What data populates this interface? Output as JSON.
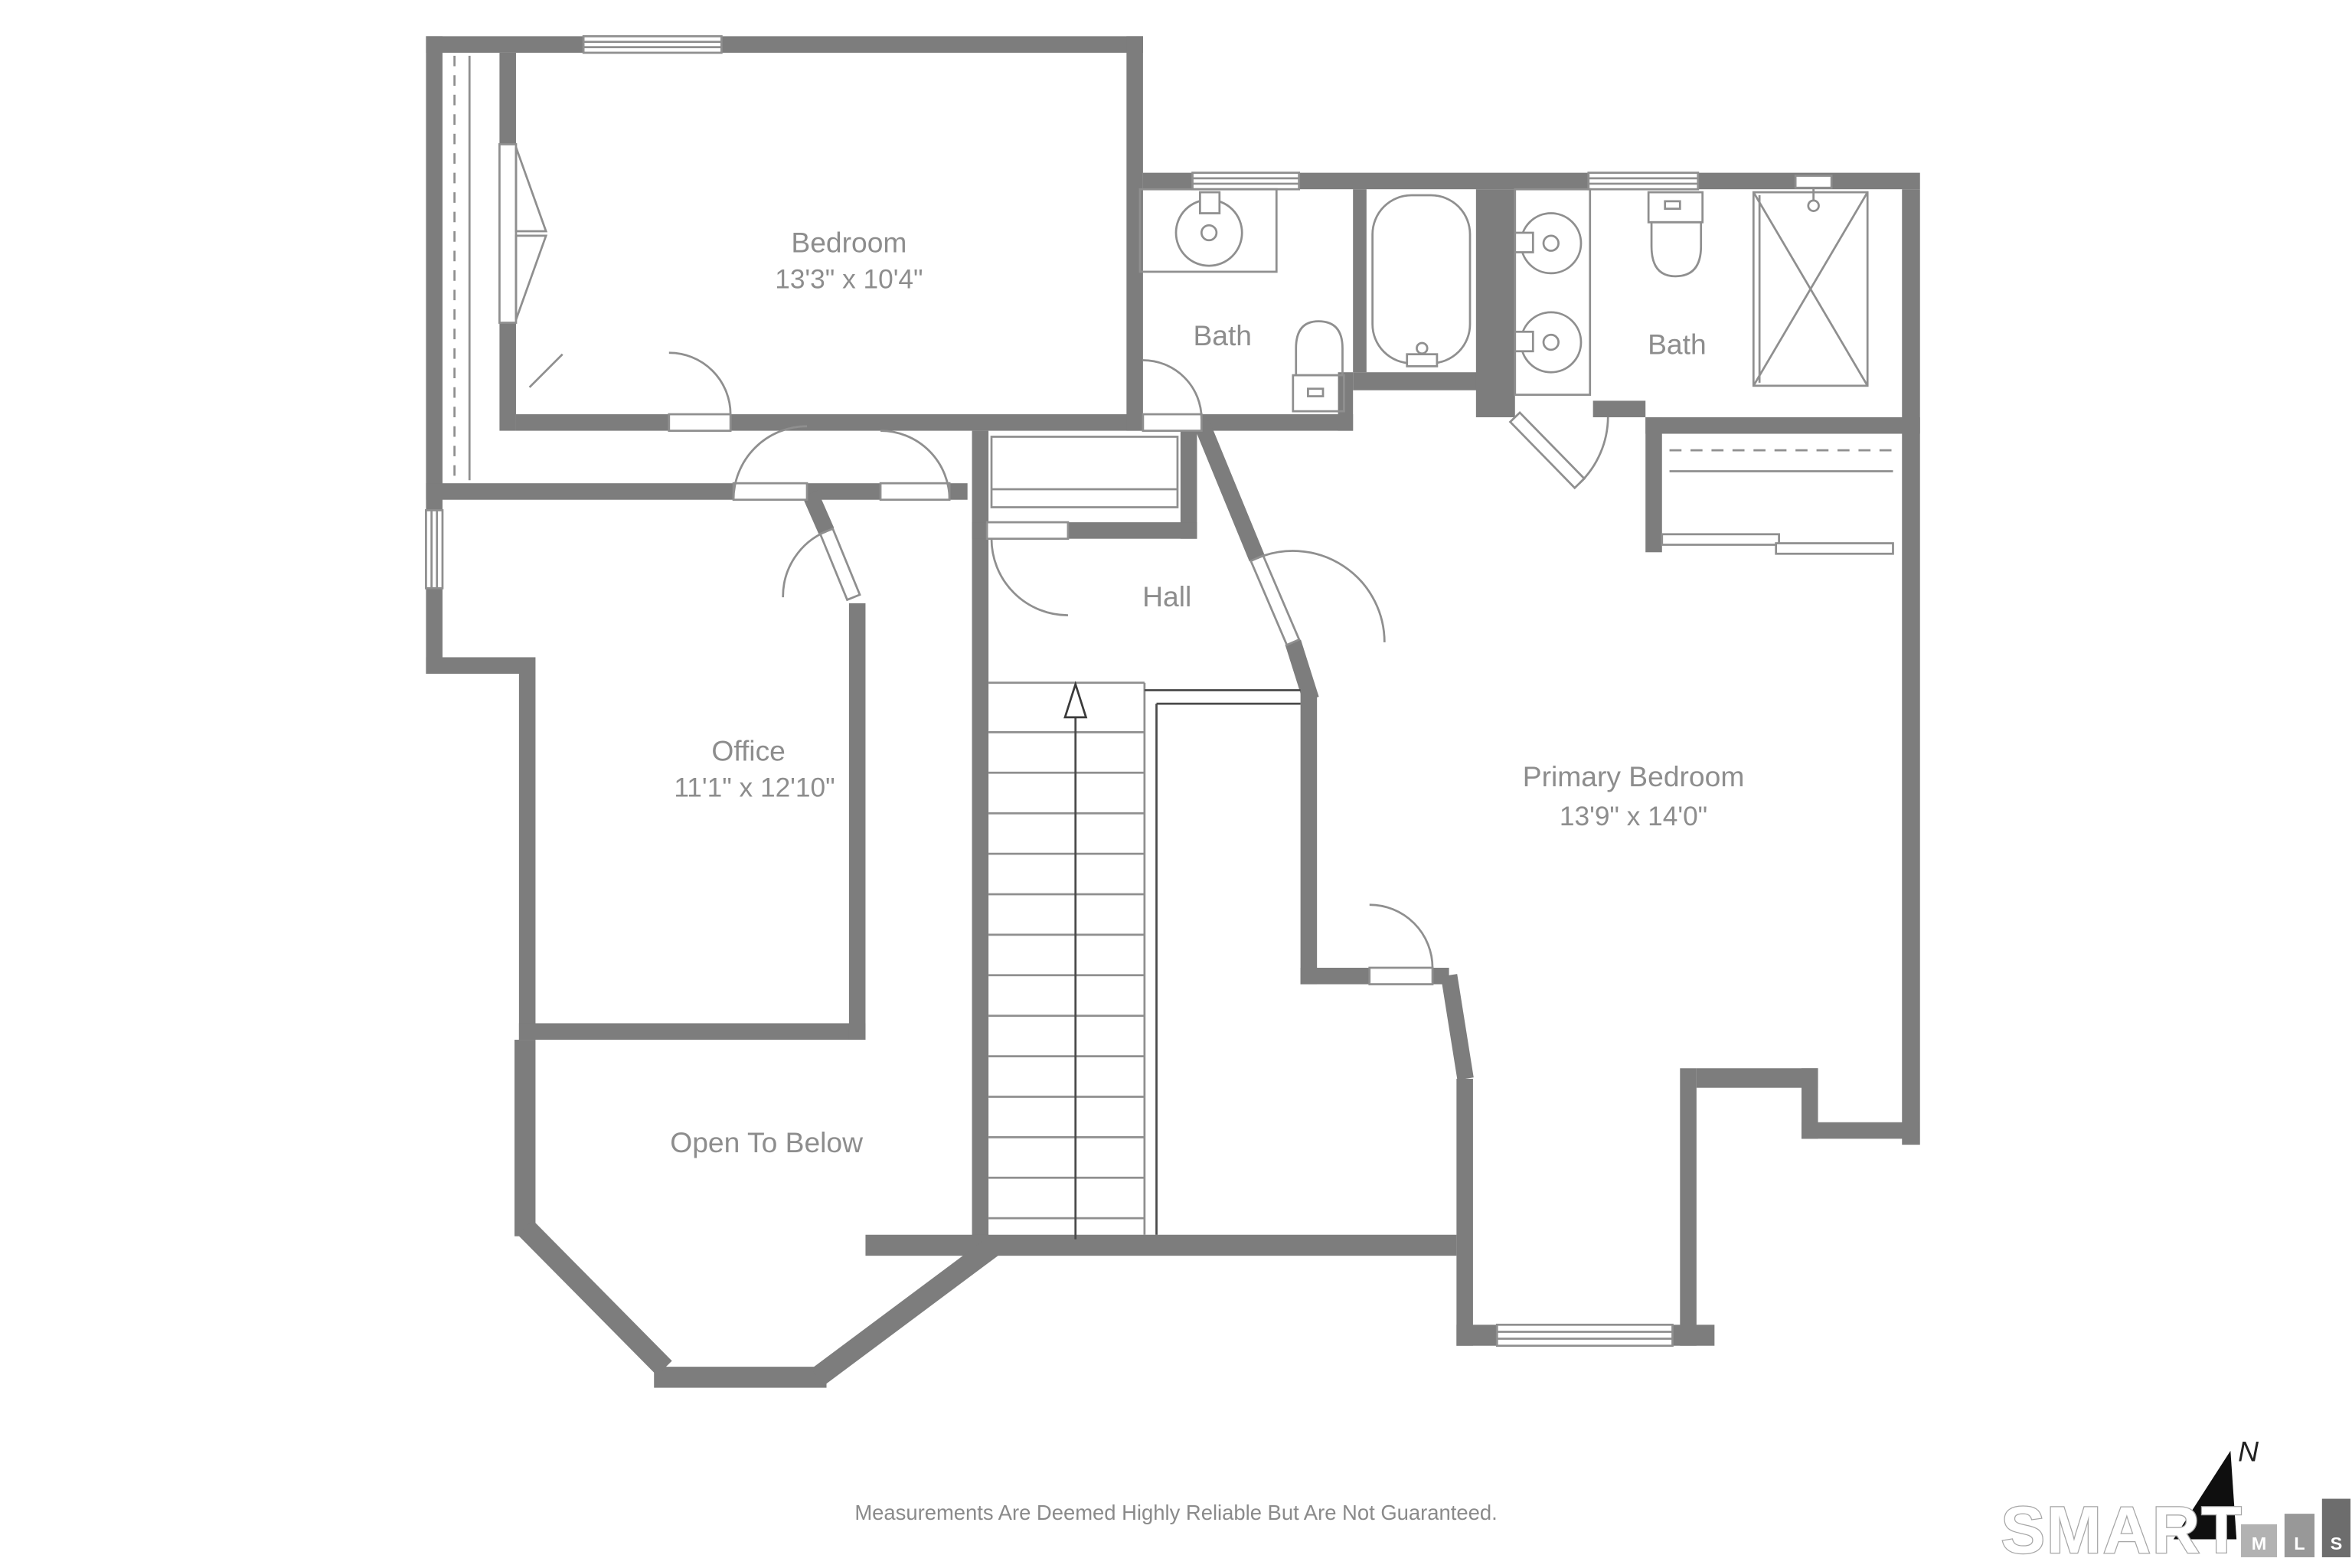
{
  "plan_title": "Upper Floor Plan",
  "rooms": [
    {
      "id": "bedroom",
      "name": "Bedroom",
      "dims": "13'3\" x 10'4\""
    },
    {
      "id": "bath-middle",
      "name": "Bath",
      "dims": ""
    },
    {
      "id": "bath-primary",
      "name": "Bath",
      "dims": ""
    },
    {
      "id": "hall",
      "name": "Hall",
      "dims": ""
    },
    {
      "id": "office",
      "name": "Office",
      "dims": "11'1\" x 12'10\""
    },
    {
      "id": "primary-bedroom",
      "name": "Primary Bedroom",
      "dims": "13'9\" x 14'0\""
    },
    {
      "id": "open-to-below",
      "name": "Open To Below",
      "dims": ""
    }
  ],
  "footer": {
    "disclaimer": "Measurements Are Deemed Highly Reliable But Are Not Guaranteed."
  },
  "branding": {
    "name": "SMART",
    "mls_letters": [
      "M",
      "L",
      "S"
    ],
    "north_label": "N"
  },
  "colors": {
    "wall": "#7d7d7d",
    "fixture_line": "#8f8f8f",
    "label_text": "#8d8d8d",
    "railing": "#4a4a4a",
    "north_arrow": "#0f0f0f"
  }
}
